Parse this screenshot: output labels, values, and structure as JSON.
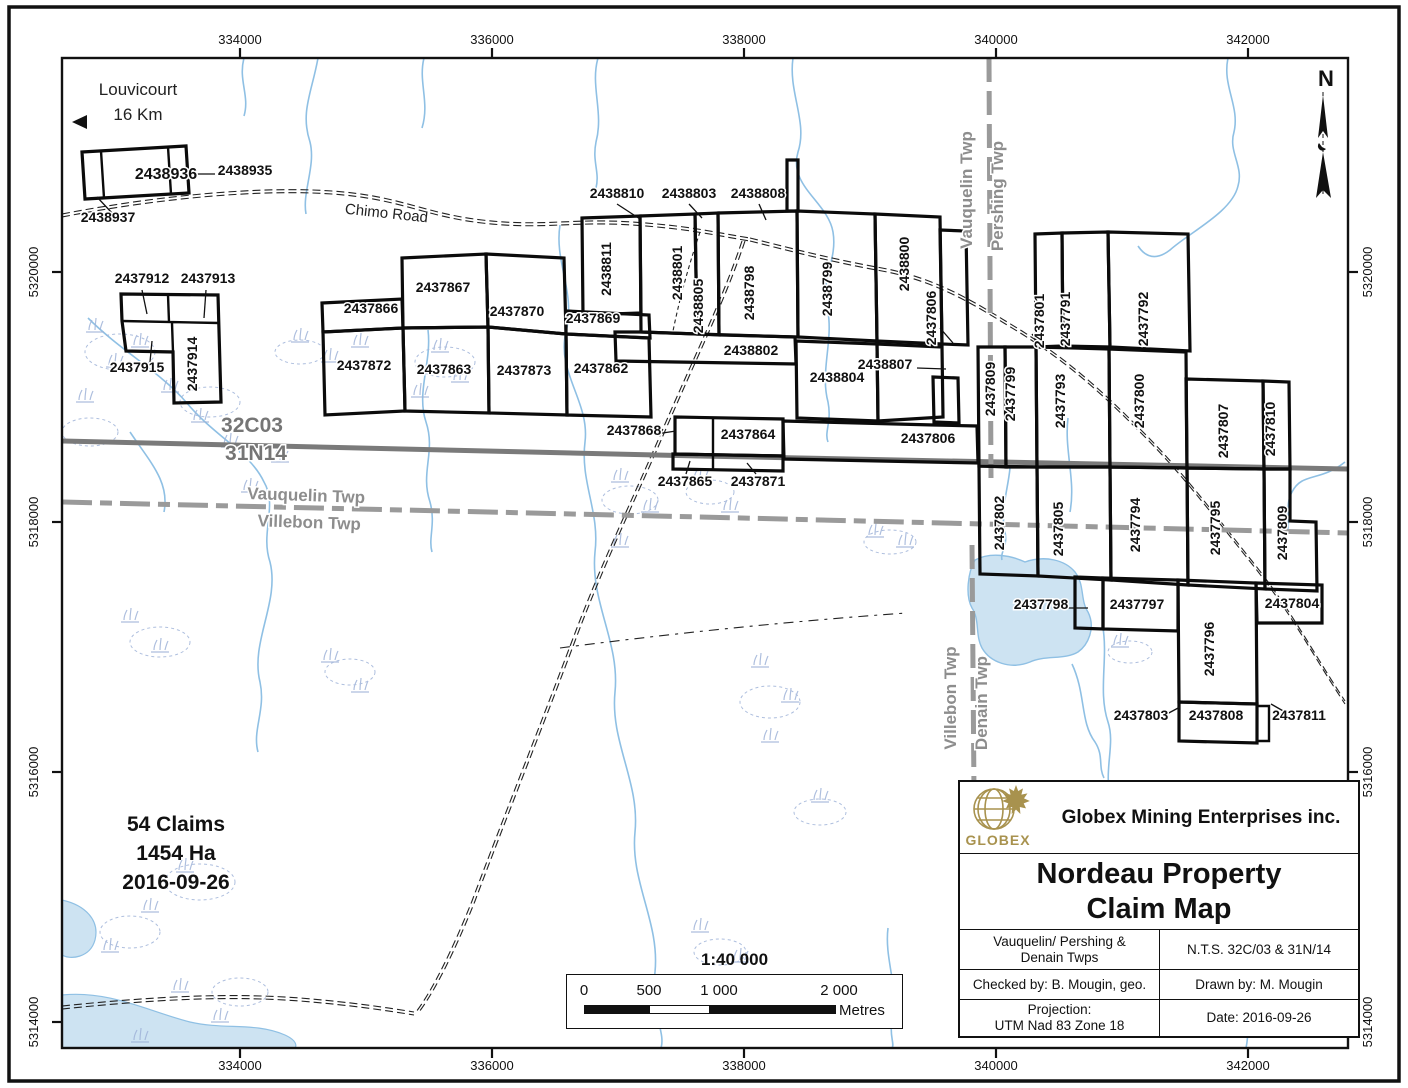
{
  "colors": {
    "water": "#8fc0e4",
    "water_fill": "#cde3f2",
    "wetland": "#9fb3d8",
    "nts_line_gray": "#7a7a7a",
    "twp_line_gray": "#9a9a9a",
    "claim_outline": "#0b0b0b",
    "logo_gold": "#a8924e"
  },
  "axis": {
    "x_ticks": [
      {
        "label": "334000",
        "x": 240
      },
      {
        "label": "336000",
        "x": 492
      },
      {
        "label": "338000",
        "x": 744
      },
      {
        "label": "340000",
        "x": 996
      },
      {
        "label": "342000",
        "x": 1248
      }
    ],
    "y_ticks": [
      {
        "label": "5320000",
        "y": 272
      },
      {
        "label": "5318000",
        "y": 522
      },
      {
        "label": "5316000",
        "y": 772
      },
      {
        "label": "5314000",
        "y": 1022
      }
    ]
  },
  "map_texts": [
    {
      "t": "Louvicourt",
      "x": 138,
      "y": 95,
      "cls": "place",
      "name": "louvicourt-label"
    },
    {
      "t": "16 Km",
      "x": 138,
      "y": 120,
      "cls": "place",
      "name": "louvicourt-distance-label"
    },
    {
      "t": "Chimo Road",
      "x": 386,
      "y": 218,
      "cls": "road-label",
      "rot": 6,
      "name": "chimo-road-label"
    },
    {
      "t": "32C03",
      "x": 252,
      "y": 432,
      "cls": "nts-label",
      "name": "nts-sheet-32c03-label"
    },
    {
      "t": "31N14",
      "x": 256,
      "y": 460,
      "cls": "nts-label",
      "name": "nts-sheet-31n14-label"
    },
    {
      "t": "Vauquelin Twp",
      "x": 306,
      "y": 501,
      "cls": "twp-label",
      "rot": 2,
      "name": "vauquelin-twp-label"
    },
    {
      "t": "Villebon Twp",
      "x": 309,
      "y": 528,
      "cls": "twp-label",
      "rot": 2,
      "name": "villebon-twp-label"
    },
    {
      "t": "Vauquelin Twp",
      "x": 972,
      "y": 190,
      "cls": "twp-label",
      "rot": -90,
      "name": "vauquelin-twp-vertical-label"
    },
    {
      "t": "Pershing Twp",
      "x": 1003,
      "y": 196,
      "cls": "twp-label",
      "rot": -90,
      "name": "pershing-twp-vertical-label"
    },
    {
      "t": "Villebon Twp",
      "x": 956,
      "y": 698,
      "cls": "twp-label",
      "rot": -90,
      "name": "villebon-twp-vertical-label"
    },
    {
      "t": "Denain Twp",
      "x": 987,
      "y": 703,
      "cls": "twp-label",
      "rot": -90,
      "name": "denain-twp-vertical-label"
    },
    {
      "t": "N",
      "x": 1326,
      "y": 86,
      "cls": "north-label",
      "name": "north-arrow-label"
    }
  ],
  "claims": [
    {
      "num": "2438936",
      "x": 166,
      "y": 179,
      "big": true
    },
    {
      "num": "2438935",
      "x": 245,
      "y": 175
    },
    {
      "num": "2438937",
      "x": 108,
      "y": 222
    },
    {
      "num": "2437912",
      "x": 142,
      "y": 283
    },
    {
      "num": "2437913",
      "x": 208,
      "y": 283
    },
    {
      "num": "2437915",
      "x": 137,
      "y": 372
    },
    {
      "num": "2437914",
      "x": 197,
      "y": 364,
      "rot": -90
    },
    {
      "num": "2437866",
      "x": 371,
      "y": 313
    },
    {
      "num": "2437867",
      "x": 443,
      "y": 292
    },
    {
      "num": "2437870",
      "x": 517,
      "y": 316
    },
    {
      "num": "2437869",
      "x": 593,
      "y": 323
    },
    {
      "num": "2437872",
      "x": 364,
      "y": 370
    },
    {
      "num": "2437863",
      "x": 444,
      "y": 374
    },
    {
      "num": "2437873",
      "x": 524,
      "y": 375
    },
    {
      "num": "2437862",
      "x": 601,
      "y": 373
    },
    {
      "num": "2437868",
      "x": 634,
      "y": 435
    },
    {
      "num": "2437864",
      "x": 748,
      "y": 439
    },
    {
      "num": "2437865",
      "x": 685,
      "y": 486
    },
    {
      "num": "2437871",
      "x": 758,
      "y": 486
    },
    {
      "num": "2438810",
      "x": 617,
      "y": 198
    },
    {
      "num": "2438803",
      "x": 689,
      "y": 198
    },
    {
      "num": "2438808",
      "x": 758,
      "y": 198
    },
    {
      "num": "2438811",
      "x": 611,
      "y": 269,
      "rot": -90
    },
    {
      "num": "2438801",
      "x": 682,
      "y": 273,
      "rot": -90
    },
    {
      "num": "2438805",
      "x": 703,
      "y": 306,
      "rot": -90
    },
    {
      "num": "2438798",
      "x": 754,
      "y": 293,
      "rot": -90
    },
    {
      "num": "2438799",
      "x": 832,
      "y": 289,
      "rot": -90
    },
    {
      "num": "2438800",
      "x": 909,
      "y": 264,
      "rot": -90
    },
    {
      "num": "2437806",
      "x": 936,
      "y": 318,
      "rot": -90
    },
    {
      "num": "2438802",
      "x": 751,
      "y": 355
    },
    {
      "num": "2438804",
      "x": 837,
      "y": 382
    },
    {
      "num": "2438807",
      "x": 885,
      "y": 369
    },
    {
      "num": "2437806",
      "x": 928,
      "y": 443
    },
    {
      "num": "2437809",
      "x": 995,
      "y": 389,
      "rot": -90
    },
    {
      "num": "2437799",
      "x": 1015,
      "y": 394,
      "rot": -90
    },
    {
      "num": "2437801",
      "x": 1044,
      "y": 321,
      "rot": -90
    },
    {
      "num": "2437791",
      "x": 1070,
      "y": 319,
      "rot": -90
    },
    {
      "num": "2437792",
      "x": 1148,
      "y": 319,
      "rot": -90
    },
    {
      "num": "2437793",
      "x": 1065,
      "y": 401,
      "rot": -90
    },
    {
      "num": "2437800",
      "x": 1144,
      "y": 401,
      "rot": -90
    },
    {
      "num": "2437807",
      "x": 1228,
      "y": 431,
      "rot": -90
    },
    {
      "num": "2437810",
      "x": 1275,
      "y": 429,
      "rot": -90
    },
    {
      "num": "2437802",
      "x": 1004,
      "y": 523,
      "rot": -90
    },
    {
      "num": "2437805",
      "x": 1063,
      "y": 529,
      "rot": -90
    },
    {
      "num": "2437794",
      "x": 1140,
      "y": 525,
      "rot": -90
    },
    {
      "num": "2437795",
      "x": 1220,
      "y": 528,
      "rot": -90
    },
    {
      "num": "2437809",
      "x": 1287,
      "y": 533,
      "rot": -90
    },
    {
      "num": "2437798",
      "x": 1041,
      "y": 609
    },
    {
      "num": "2437797",
      "x": 1137,
      "y": 609
    },
    {
      "num": "2437804",
      "x": 1292,
      "y": 608
    },
    {
      "num": "2437796",
      "x": 1214,
      "y": 649,
      "rot": -90
    },
    {
      "num": "2437803",
      "x": 1141,
      "y": 720
    },
    {
      "num": "2437808",
      "x": 1216,
      "y": 720
    },
    {
      "num": "2437811",
      "x": 1299,
      "y": 720
    }
  ],
  "leaders": [
    [
      215,
      174,
      186,
      174
    ],
    [
      112,
      213,
      97,
      197
    ],
    [
      142,
      290,
      147,
      314
    ],
    [
      206,
      290,
      204,
      318
    ],
    [
      150,
      362,
      152,
      341
    ],
    [
      617,
      204,
      640,
      219
    ],
    [
      689,
      204,
      702,
      218
    ],
    [
      759,
      204,
      766,
      220
    ],
    [
      940,
      328,
      953,
      343
    ],
    [
      917,
      368,
      946,
      369
    ],
    [
      1032,
      334,
      1041,
      346
    ],
    [
      656,
      434,
      676,
      431
    ],
    [
      686,
      474,
      690,
      461
    ],
    [
      756,
      474,
      747,
      463
    ],
    [
      1063,
      608,
      1088,
      608
    ],
    [
      1165,
      715,
      1180,
      707
    ],
    [
      1285,
      712,
      1271,
      704
    ]
  ],
  "summary": {
    "lines": [
      "54 Claims",
      "1454 Ha",
      "2016-09-26"
    ]
  },
  "scale_bar": {
    "ratio": "1:40 000",
    "ticks": [
      "0",
      "500",
      "1 000",
      "2 000"
    ],
    "unit": "Metres"
  },
  "title_block": {
    "logo_text": "GLOBEX",
    "company": "Globex Mining Enterprises inc.",
    "title_line1": "Nordeau Property",
    "title_line2": "Claim Map",
    "township_line1": "Vauquelin/ Pershing &",
    "township_line2": "Denain Twps",
    "nts": "N.T.S. 32C/03 & 31N/14",
    "checked_by": "Checked by: B. Mougin, geo.",
    "drawn_by": "Drawn by: M. Mougin",
    "projection_line1": "Projection:",
    "projection_line2": "UTM Nad 83 Zone 18",
    "date": "Date: 2016-09-26"
  }
}
